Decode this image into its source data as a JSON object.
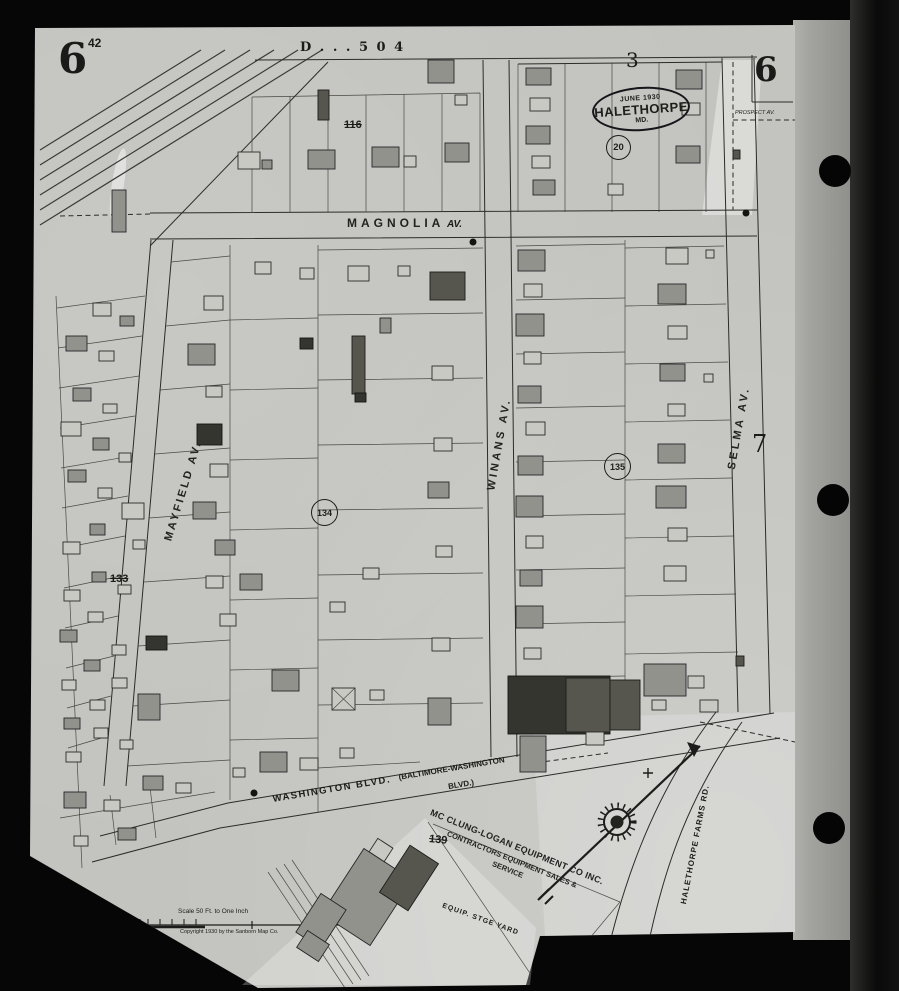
{
  "scan": {
    "film_number": "42"
  },
  "sheet": {
    "number_top_left": "6",
    "number_top_right": "6",
    "plate_header": "D . . . 5 0 4",
    "adjacent_sheet_top": "3",
    "adjacent_sheet_right": "7",
    "stamp": {
      "date": "JUNE 1930",
      "town": "HALETHORPE",
      "state": "MD."
    },
    "circled": {
      "n20": "20",
      "n134": "134",
      "n135": "135"
    },
    "crossed": {
      "n116": "116",
      "n133": "133",
      "n139": "139"
    }
  },
  "streets": {
    "magnolia": "MAGNOLIA",
    "magnolia_suffix": "AV.",
    "winans": "WINANS AV.",
    "selma": "SELMA AV.",
    "mayfield": "MAYFIELD AV.",
    "prospect": "PROSPECT AV.",
    "washington_main": "WASHINGTON BLVD.",
    "washington_paren": "(BALTIMORE-WASHINGTON",
    "washington_paren2": "BLVD.)",
    "halethorpe_farms": "HALETHORPE FARMS RD."
  },
  "annotations": {
    "company_line1": "MC CLUNG-LOGAN EQUIPMENT CO INC.",
    "company_line2": "CONTRACTORS EQUIPMENT SALES &",
    "company_line3": "SERVICE",
    "yard": "EQUIP. STGE YARD",
    "scale_label": "Scale 50 Ft. to One Inch",
    "copyright": "Copyright 1930 by the Sanborn Map Co."
  },
  "colors": {
    "paper": "#c3c3bf",
    "film_strip": "#a2a29e",
    "background": "#060606",
    "ink": "#1e1e1c",
    "building_shaded": "#92928c",
    "building_dark": "#3a3a34"
  },
  "map_features": {
    "buildings": [
      [
        112,
        190,
        14,
        42,
        "g"
      ],
      [
        318,
        90,
        11,
        30,
        "d"
      ],
      [
        428,
        60,
        26,
        23,
        "g"
      ],
      [
        455,
        95,
        12,
        10,
        "o"
      ],
      [
        238,
        152,
        22,
        17,
        "o"
      ],
      [
        262,
        160,
        10,
        9,
        "g"
      ],
      [
        308,
        150,
        27,
        19,
        "g"
      ],
      [
        372,
        147,
        27,
        20,
        "g"
      ],
      [
        404,
        156,
        12,
        11,
        "o"
      ],
      [
        445,
        143,
        24,
        19,
        "g"
      ],
      [
        526,
        68,
        25,
        17,
        "g"
      ],
      [
        530,
        98,
        20,
        13,
        "o"
      ],
      [
        526,
        126,
        24,
        18,
        "g"
      ],
      [
        532,
        156,
        18,
        12,
        "o"
      ],
      [
        533,
        180,
        22,
        15,
        "g"
      ],
      [
        676,
        70,
        26,
        19,
        "g"
      ],
      [
        682,
        103,
        18,
        12,
        "o"
      ],
      [
        676,
        146,
        24,
        17,
        "g"
      ],
      [
        733,
        150,
        7,
        9,
        "d"
      ],
      [
        608,
        184,
        15,
        11,
        "o"
      ],
      [
        518,
        250,
        27,
        21,
        "g"
      ],
      [
        524,
        284,
        18,
        13,
        "o"
      ],
      [
        516,
        314,
        28,
        22,
        "g"
      ],
      [
        524,
        352,
        17,
        12,
        "o"
      ],
      [
        518,
        386,
        23,
        17,
        "g"
      ],
      [
        526,
        422,
        19,
        13,
        "o"
      ],
      [
        518,
        456,
        25,
        19,
        "g"
      ],
      [
        516,
        496,
        27,
        21,
        "g"
      ],
      [
        526,
        536,
        17,
        12,
        "o"
      ],
      [
        520,
        570,
        22,
        16,
        "g"
      ],
      [
        516,
        606,
        27,
        22,
        "g"
      ],
      [
        524,
        648,
        17,
        11,
        "o"
      ],
      [
        666,
        248,
        22,
        16,
        "o"
      ],
      [
        658,
        284,
        28,
        20,
        "g"
      ],
      [
        668,
        326,
        19,
        13,
        "o"
      ],
      [
        660,
        364,
        25,
        17,
        "g"
      ],
      [
        668,
        404,
        17,
        12,
        "o"
      ],
      [
        658,
        444,
        27,
        19,
        "g"
      ],
      [
        656,
        486,
        30,
        22,
        "g"
      ],
      [
        668,
        528,
        19,
        13,
        "o"
      ],
      [
        664,
        566,
        22,
        15,
        "o"
      ],
      [
        704,
        374,
        9,
        8,
        "o"
      ],
      [
        706,
        250,
        8,
        8,
        "o"
      ],
      [
        508,
        676,
        102,
        58,
        "k"
      ],
      [
        566,
        678,
        44,
        54,
        "d"
      ],
      [
        610,
        680,
        30,
        50,
        "d"
      ],
      [
        520,
        736,
        26,
        36,
        "g"
      ],
      [
        586,
        732,
        18,
        13,
        "o"
      ],
      [
        644,
        664,
        42,
        32,
        "g"
      ],
      [
        688,
        676,
        16,
        12,
        "o"
      ],
      [
        700,
        700,
        18,
        12,
        "o"
      ],
      [
        652,
        700,
        14,
        10,
        "o"
      ],
      [
        736,
        656,
        8,
        10,
        "d"
      ],
      [
        204,
        296,
        19,
        14,
        "o"
      ],
      [
        188,
        344,
        27,
        21,
        "g"
      ],
      [
        206,
        386,
        16,
        11,
        "o"
      ],
      [
        197,
        424,
        25,
        21,
        "k"
      ],
      [
        210,
        464,
        18,
        13,
        "o"
      ],
      [
        193,
        502,
        23,
        17,
        "g"
      ],
      [
        215,
        540,
        20,
        15,
        "g"
      ],
      [
        206,
        576,
        17,
        12,
        "o"
      ],
      [
        220,
        614,
        16,
        12,
        "o"
      ],
      [
        255,
        262,
        16,
        12,
        "o"
      ],
      [
        300,
        268,
        14,
        11,
        "o"
      ],
      [
        348,
        266,
        21,
        15,
        "o"
      ],
      [
        398,
        266,
        12,
        10,
        "o"
      ],
      [
        430,
        272,
        35,
        28,
        "d"
      ],
      [
        300,
        338,
        13,
        11,
        "k"
      ],
      [
        352,
        336,
        13,
        58,
        "d"
      ],
      [
        380,
        318,
        11,
        15,
        "g"
      ],
      [
        432,
        366,
        21,
        14,
        "o"
      ],
      [
        355,
        393,
        11,
        9,
        "k"
      ],
      [
        434,
        438,
        18,
        13,
        "o"
      ],
      [
        428,
        482,
        21,
        16,
        "g"
      ],
      [
        240,
        574,
        22,
        16,
        "g"
      ],
      [
        436,
        546,
        16,
        11,
        "o"
      ],
      [
        363,
        568,
        16,
        11,
        "o"
      ],
      [
        330,
        602,
        15,
        10,
        "o"
      ],
      [
        432,
        638,
        18,
        13,
        "o"
      ],
      [
        272,
        670,
        27,
        21,
        "g"
      ],
      [
        332,
        688,
        23,
        22,
        "x"
      ],
      [
        370,
        690,
        14,
        10,
        "o"
      ],
      [
        428,
        698,
        23,
        27,
        "g"
      ],
      [
        260,
        752,
        27,
        20,
        "g"
      ],
      [
        300,
        758,
        18,
        12,
        "o"
      ],
      [
        233,
        768,
        12,
        9,
        "o"
      ],
      [
        340,
        748,
        14,
        10,
        "o"
      ],
      [
        93,
        303,
        18,
        13,
        "o"
      ],
      [
        120,
        316,
        14,
        10,
        "g"
      ],
      [
        66,
        336,
        21,
        15,
        "g"
      ],
      [
        99,
        351,
        15,
        10,
        "o"
      ],
      [
        73,
        388,
        18,
        13,
        "g"
      ],
      [
        103,
        404,
        14,
        9,
        "o"
      ],
      [
        61,
        422,
        20,
        14,
        "o"
      ],
      [
        93,
        438,
        16,
        12,
        "g"
      ],
      [
        119,
        453,
        12,
        9,
        "o"
      ],
      [
        68,
        470,
        18,
        12,
        "g"
      ],
      [
        98,
        488,
        14,
        10,
        "o"
      ],
      [
        122,
        503,
        22,
        16,
        "o"
      ],
      [
        90,
        524,
        15,
        11,
        "g"
      ],
      [
        63,
        542,
        17,
        12,
        "o"
      ],
      [
        133,
        540,
        12,
        9,
        "o"
      ],
      [
        92,
        572,
        14,
        10,
        "g"
      ],
      [
        64,
        590,
        16,
        11,
        "o"
      ],
      [
        118,
        585,
        13,
        9,
        "o"
      ],
      [
        88,
        612,
        15,
        10,
        "o"
      ],
      [
        60,
        630,
        17,
        12,
        "g"
      ],
      [
        146,
        636,
        21,
        14,
        "k"
      ],
      [
        112,
        645,
        14,
        10,
        "o"
      ],
      [
        84,
        660,
        16,
        11,
        "g"
      ],
      [
        62,
        680,
        14,
        10,
        "o"
      ],
      [
        112,
        678,
        15,
        10,
        "o"
      ],
      [
        138,
        694,
        22,
        26,
        "g"
      ],
      [
        90,
        700,
        15,
        10,
        "o"
      ],
      [
        64,
        718,
        16,
        11,
        "g"
      ],
      [
        94,
        728,
        14,
        10,
        "o"
      ],
      [
        120,
        740,
        13,
        9,
        "o"
      ],
      [
        66,
        752,
        15,
        10,
        "o"
      ],
      [
        64,
        792,
        22,
        16,
        "g"
      ],
      [
        104,
        800,
        16,
        11,
        "o"
      ],
      [
        143,
        776,
        20,
        14,
        "g"
      ],
      [
        176,
        783,
        15,
        10,
        "o"
      ],
      [
        118,
        828,
        18,
        12,
        "g"
      ],
      [
        74,
        836,
        14,
        10,
        "o"
      ],
      [
        338,
        858,
        58,
        78,
        "g",
        33
      ],
      [
        392,
        850,
        34,
        56,
        "d",
        33
      ],
      [
        306,
        898,
        30,
        46,
        "g",
        33
      ],
      [
        372,
        842,
        18,
        16,
        "o",
        33
      ],
      [
        300,
        936,
        26,
        20,
        "g",
        33
      ]
    ],
    "dots": [
      [
        473,
        242
      ],
      [
        746,
        213
      ],
      [
        254,
        793
      ]
    ]
  }
}
